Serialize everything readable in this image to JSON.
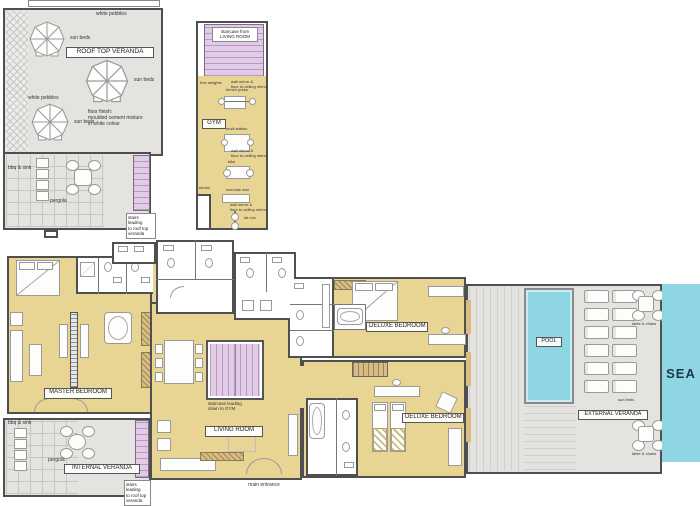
{
  "colors": {
    "room": "#e8d593",
    "outdoor": "#e4e3e0",
    "stairs": "#e2cbe7",
    "water": "#8fd6e5",
    "wall": "#4f4f4f",
    "wood": "#d8bc82"
  },
  "roof_veranda": {
    "title": "ROOF TOP VERANDA",
    "white_pebbles_top": "white pebbles",
    "white_pebbles_left": "white pebbles",
    "sun_beds_1": "sun beds",
    "sun_beds_2": "sun beds",
    "sun_beds_3": "sun beds",
    "floor_note": "floor finish:\nmoulded cement mixture\nin white colour"
  },
  "roof_terrace": {
    "bbq_sink": "bbq & sink",
    "pergola": "pergola",
    "stairs_note": "stairs leading\nto roof top\nveranda"
  },
  "gym_floor": {
    "gym": "GYM",
    "staircase": "staircase from\nLIVING ROOM",
    "free_weights": "free weights",
    "wall_mirror_1": "wall mirror &\nfloor to ceiling mirror",
    "bench_press": "bench press",
    "multi_station": "multi station",
    "wall_mirror_2": "wall mirror &\nfloor to ceiling mirror",
    "exercise_bike": "bike",
    "exercise_mat": "exercise mat",
    "bench": "bench",
    "wall_mirror_3": "wall mirror &\nfloor to ceiling mirror",
    "lat_machine": "lat m/c"
  },
  "main_floor": {
    "master_bedroom": "MASTER BEDROOM",
    "living_room": "LIVING ROOM",
    "deluxe_bedroom_1": "DELUXE BEDROOM",
    "deluxe_bedroom_2": "DELUXE BEDROOM",
    "internal_veranda": "INTERNAL VERANDA",
    "external_veranda": "EXTERNAL VERANDA",
    "pool": "POOL",
    "sea": "SEA",
    "main_entrance": "main entrance",
    "staircase_note": "staircase leading\ndown to GYM",
    "iv_bbq_sink": "bbq & sink",
    "iv_pergola": "pergola",
    "iv_stairs_note": "stairs leading\nto roof top\nveranda",
    "ev_sun_beds": "sun beds",
    "ev_table_1": "table & chairs",
    "ev_table_2": "table & chairs"
  }
}
